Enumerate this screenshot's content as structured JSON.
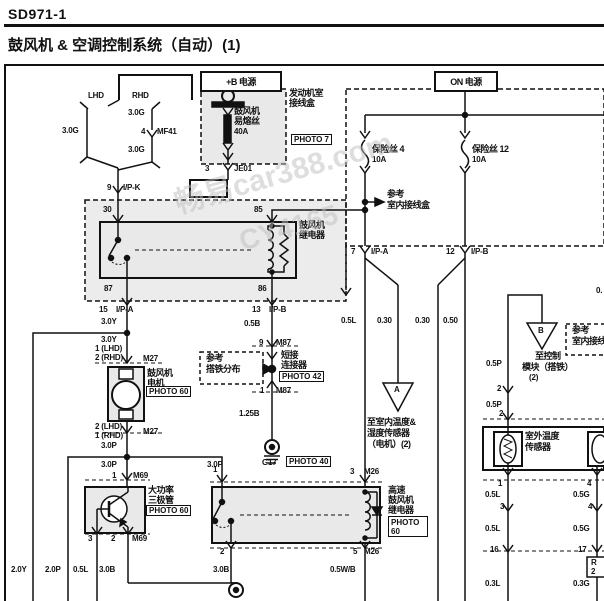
{
  "page": {
    "doc_code": "SD971-1",
    "title": "鼓风机 & 空调控制系统（自动）(1)"
  },
  "watermark": {
    "line1": "畅易car388.com",
    "line2": "CY4165"
  },
  "power_boxes": {
    "b_plus": "+B 电源",
    "on": "ON 电源"
  },
  "photo_refs": {
    "p7": "PHOTO 7",
    "p42": "PHOTO 42",
    "p40": "PHOTO 40",
    "p60_motor": "PHOTO 60",
    "p60_tr": "PHOTO 60",
    "p60_hs_1": "PHOTO",
    "p60_hs_2": "60"
  },
  "components": {
    "engine_room_box": "发动机室接线盒",
    "blower_fusible_link": "鼓风机易熔丝 40A",
    "fuse4": "保险丝 4 10A",
    "fuse12": "保险丝 12 10A",
    "blower_relay": "鼓风机继电器",
    "blower_motor": "鼓风机电机",
    "jumper_connector": "短接连接器",
    "power_transistor": "大功率三极管",
    "high_speed_blower_relay": "高速鼓风机继电器",
    "ambient_temp_sensor": "室外温度传感器",
    "ref_indoor_junction_box": "参考 室内接线盒",
    "ref_ground_distribution": "参考 搭铁分布",
    "to_indoor_temp_humidity_sensor": "至室内温度&湿度传感器（电机）(2)",
    "to_control_module_ground": "至控制模块（搭铁）(2)",
    "ground_g17": "G17"
  },
  "labels": [
    {
      "t": "LHD",
      "x": 88,
      "y": 92,
      "c": "w",
      "n": "label-lhd"
    },
    {
      "t": "RHD",
      "x": 132,
      "y": 92,
      "c": "w",
      "n": "label-rhd"
    },
    {
      "t": "3.0G",
      "x": 62,
      "y": 127,
      "c": "w",
      "n": "wire-3-0g-lhd"
    },
    {
      "t": "3.0G",
      "x": 128,
      "y": 109,
      "c": "w",
      "n": "wire-3-0g-rhd-1"
    },
    {
      "t": "4",
      "x": 141,
      "y": 128,
      "c": "w",
      "n": "pin-4-mf41"
    },
    {
      "t": "MF41",
      "x": 157,
      "y": 128,
      "c": "w",
      "n": "connector-mf41"
    },
    {
      "t": "3.0G",
      "x": 128,
      "y": 146,
      "c": "w",
      "n": "wire-3-0g-rhd-2"
    },
    {
      "t": "9",
      "x": 107,
      "y": 184,
      "c": "w",
      "n": "pin-9-ipk"
    },
    {
      "t": "I/P-K",
      "x": 123,
      "y": 184,
      "c": "w",
      "n": "connector-ipk"
    },
    {
      "t": "30",
      "x": 103,
      "y": 206,
      "c": "w",
      "n": "relay-pin-30"
    },
    {
      "t": "85",
      "x": 254,
      "y": 206,
      "c": "w",
      "n": "relay-pin-85"
    },
    {
      "t": "鼓风机",
      "x": 299,
      "y": 221,
      "c": "c",
      "n": "blower-relay-label-1"
    },
    {
      "t": "继电器",
      "x": 299,
      "y": 231,
      "c": "c",
      "n": "blower-relay-label-2"
    },
    {
      "t": "87",
      "x": 104,
      "y": 285,
      "c": "w",
      "n": "relay-pin-87"
    },
    {
      "t": "86",
      "x": 258,
      "y": 285,
      "c": "w",
      "n": "relay-pin-86"
    },
    {
      "t": "15",
      "x": 99,
      "y": 306,
      "c": "w",
      "n": "pin-15-ipa"
    },
    {
      "t": "I/P-A",
      "x": 116,
      "y": 306,
      "c": "w",
      "n": "connector-ipa-left"
    },
    {
      "t": "13",
      "x": 252,
      "y": 306,
      "c": "w",
      "n": "pin-13-ipb"
    },
    {
      "t": "I/P-B",
      "x": 269,
      "y": 306,
      "c": "w",
      "n": "connector-ipb-left"
    },
    {
      "t": "3.0Y",
      "x": 101,
      "y": 318,
      "c": "w",
      "n": "wire-3-0y-1"
    },
    {
      "t": "3.0Y",
      "x": 101,
      "y": 336,
      "c": "w",
      "n": "wire-3-0y-2"
    },
    {
      "t": "1 (LHD)",
      "x": 95,
      "y": 345,
      "c": "w",
      "n": "motor-pin-top-lhd"
    },
    {
      "t": "2 (RHD)",
      "x": 95,
      "y": 354,
      "c": "w",
      "n": "motor-pin-top-rhd"
    },
    {
      "t": "M27",
      "x": 143,
      "y": 355,
      "c": "w",
      "n": "connector-m27-top"
    },
    {
      "t": "鼓风机",
      "x": 147,
      "y": 369,
      "c": "c",
      "n": "blower-motor-label-1"
    },
    {
      "t": "电机",
      "x": 147,
      "y": 379,
      "c": "c",
      "n": "blower-motor-label-2"
    },
    {
      "t": "参考",
      "x": 206,
      "y": 354,
      "c": "c",
      "n": "ref-ground-dist-1"
    },
    {
      "t": "搭铁分布",
      "x": 206,
      "y": 365,
      "c": "c",
      "n": "ref-ground-dist-2"
    },
    {
      "t": "0.5B",
      "x": 244,
      "y": 320,
      "c": "w",
      "n": "wire-0-5b"
    },
    {
      "t": "9",
      "x": 259,
      "y": 339,
      "c": "w",
      "n": "pin-9-m87"
    },
    {
      "t": "M87",
      "x": 276,
      "y": 339,
      "c": "w",
      "n": "connector-m87-top"
    },
    {
      "t": "短接",
      "x": 281,
      "y": 351,
      "c": "c",
      "n": "jumper-label-1"
    },
    {
      "t": "连接器",
      "x": 281,
      "y": 361,
      "c": "c",
      "n": "jumper-label-2"
    },
    {
      "t": "1",
      "x": 260,
      "y": 387,
      "c": "w",
      "n": "pin-1-m87"
    },
    {
      "t": "M87",
      "x": 276,
      "y": 387,
      "c": "w",
      "n": "connector-m87-bottom"
    },
    {
      "t": "1.25B",
      "x": 239,
      "y": 410,
      "c": "w",
      "n": "wire-1-25b"
    },
    {
      "t": "G17",
      "x": 262,
      "y": 459,
      "c": "w",
      "n": "ground-g17-label"
    },
    {
      "t": "2 (LHD)",
      "x": 95,
      "y": 423,
      "c": "w",
      "n": "motor-pin-bot-lhd"
    },
    {
      "t": "1 (RHD)",
      "x": 95,
      "y": 432,
      "c": "w",
      "n": "motor-pin-bot-rhd"
    },
    {
      "t": "M27",
      "x": 143,
      "y": 428,
      "c": "w",
      "n": "connector-m27-bottom"
    },
    {
      "t": "3.0P",
      "x": 101,
      "y": 442,
      "c": "w",
      "n": "wire-3-0p-1"
    },
    {
      "t": "3.0P",
      "x": 101,
      "y": 461,
      "c": "w",
      "n": "wire-3-0p-2"
    },
    {
      "t": "3.0P",
      "x": 207,
      "y": 461,
      "c": "w",
      "n": "wire-3-0p-3"
    },
    {
      "t": "1",
      "x": 112,
      "y": 472,
      "c": "w",
      "n": "transistor-pin-1"
    },
    {
      "t": "M69",
      "x": 133,
      "y": 472,
      "c": "w",
      "n": "connector-m69-top"
    },
    {
      "t": "大功率",
      "x": 148,
      "y": 486,
      "c": "c",
      "n": "power-transistor-label-1"
    },
    {
      "t": "三极管",
      "x": 148,
      "y": 496,
      "c": "c",
      "n": "power-transistor-label-2"
    },
    {
      "t": "3",
      "x": 88,
      "y": 535,
      "c": "w",
      "n": "transistor-pin-3"
    },
    {
      "t": "2",
      "x": 111,
      "y": 535,
      "c": "w",
      "n": "transistor-pin-2"
    },
    {
      "t": "M69",
      "x": 132,
      "y": 535,
      "c": "w",
      "n": "connector-m69-bottom"
    },
    {
      "t": "2.0Y",
      "x": 11,
      "y": 566,
      "c": "w",
      "n": "wire-2-0y"
    },
    {
      "t": "2.0P",
      "x": 45,
      "y": 566,
      "c": "w",
      "n": "wire-2-0p"
    },
    {
      "t": "0.5L",
      "x": 73,
      "y": 566,
      "c": "w",
      "n": "wire-0-5l-bottom"
    },
    {
      "t": "3.0B",
      "x": 99,
      "y": 566,
      "c": "w",
      "n": "wire-3-0b-left"
    },
    {
      "t": "3.0B",
      "x": 213,
      "y": 566,
      "c": "w",
      "n": "wire-3-0b-relay"
    },
    {
      "t": "0.5W/B",
      "x": 330,
      "y": 566,
      "c": "w",
      "n": "wire-0-5wb"
    },
    {
      "t": "1",
      "x": 213,
      "y": 466,
      "c": "w",
      "n": "hs-relay-pin-1"
    },
    {
      "t": "3",
      "x": 350,
      "y": 468,
      "c": "w",
      "n": "hs-relay-pin-3"
    },
    {
      "t": "M26",
      "x": 364,
      "y": 468,
      "c": "w",
      "n": "connector-m26-top"
    },
    {
      "t": "高速",
      "x": 388,
      "y": 486,
      "c": "c",
      "n": "hs-relay-label-1"
    },
    {
      "t": "鼓风机",
      "x": 388,
      "y": 496,
      "c": "c",
      "n": "hs-relay-label-2"
    },
    {
      "t": "继电器",
      "x": 388,
      "y": 506,
      "c": "c",
      "n": "hs-relay-label-3"
    },
    {
      "t": "2",
      "x": 220,
      "y": 548,
      "c": "w",
      "n": "hs-relay-pin-2"
    },
    {
      "t": "5",
      "x": 353,
      "y": 548,
      "c": "w",
      "n": "hs-relay-pin-5"
    },
    {
      "t": "M26",
      "x": 364,
      "y": 548,
      "c": "w",
      "n": "connector-m26-bottom"
    },
    {
      "t": "发动机室",
      "x": 289,
      "y": 89,
      "c": "c",
      "n": "engine-room-box-label-1"
    },
    {
      "t": "接线盒",
      "x": 289,
      "y": 99,
      "c": "c",
      "n": "engine-room-box-label-2"
    },
    {
      "t": "鼓风机",
      "x": 234,
      "y": 107,
      "c": "c",
      "n": "fusible-link-label-1"
    },
    {
      "t": "易熔丝",
      "x": 234,
      "y": 117,
      "c": "c",
      "n": "fusible-link-label-2"
    },
    {
      "t": "40A",
      "x": 234,
      "y": 128,
      "c": "w",
      "n": "fusible-link-rating"
    },
    {
      "t": "3",
      "x": 205,
      "y": 165,
      "c": "w",
      "n": "pin-3-je01"
    },
    {
      "t": "JE01",
      "x": 234,
      "y": 165,
      "c": "w",
      "n": "connector-je01"
    },
    {
      "t": "保险丝 4",
      "x": 372,
      "y": 145,
      "c": "c",
      "n": "fuse4-label"
    },
    {
      "t": "10A",
      "x": 372,
      "y": 156,
      "c": "w",
      "n": "fuse4-rating"
    },
    {
      "t": "保险丝 12",
      "x": 472,
      "y": 145,
      "c": "c",
      "n": "fuse12-label"
    },
    {
      "t": "10A",
      "x": 472,
      "y": 156,
      "c": "w",
      "n": "fuse12-rating"
    },
    {
      "t": "参考",
      "x": 387,
      "y": 190,
      "c": "c",
      "n": "ref-indoor-box-1"
    },
    {
      "t": "室内接线盒",
      "x": 387,
      "y": 201,
      "c": "c",
      "n": "ref-indoor-box-2"
    },
    {
      "t": "7",
      "x": 351,
      "y": 248,
      "c": "w",
      "n": "pin-7-ipa"
    },
    {
      "t": "I/P-A",
      "x": 371,
      "y": 248,
      "c": "w",
      "n": "connector-ipa-right"
    },
    {
      "t": "12",
      "x": 446,
      "y": 248,
      "c": "w",
      "n": "pin-12-ipb"
    },
    {
      "t": "I/P-B",
      "x": 471,
      "y": 248,
      "c": "w",
      "n": "connector-ipb-right"
    },
    {
      "t": "0.5L",
      "x": 341,
      "y": 317,
      "c": "w",
      "n": "wire-0-5l-mid"
    },
    {
      "t": "0.30",
      "x": 377,
      "y": 317,
      "c": "w",
      "n": "wire-0-30-a"
    },
    {
      "t": "0.30",
      "x": 415,
      "y": 317,
      "c": "w",
      "n": "wire-0-30-b"
    },
    {
      "t": "0.50",
      "x": 443,
      "y": 317,
      "c": "w",
      "n": "wire-0-50"
    },
    {
      "t": "A",
      "x": 394,
      "y": 386,
      "c": "w",
      "n": "offpage-a"
    },
    {
      "t": "至室内温度&",
      "x": 367,
      "y": 418,
      "c": "c",
      "n": "to-indoor-sensor-1"
    },
    {
      "t": "湿度传感器",
      "x": 367,
      "y": 429,
      "c": "c",
      "n": "to-indoor-sensor-2"
    },
    {
      "t": "（电机）(2)",
      "x": 367,
      "y": 440,
      "c": "c",
      "n": "to-indoor-sensor-3"
    },
    {
      "t": "B",
      "x": 538,
      "y": 327,
      "c": "w",
      "n": "offpage-b"
    },
    {
      "t": "至控制",
      "x": 535,
      "y": 352,
      "c": "c",
      "n": "to-control-module-1"
    },
    {
      "t": "模块（搭铁）",
      "x": 522,
      "y": 363,
      "c": "c",
      "n": "to-control-module-2"
    },
    {
      "t": "(2)",
      "x": 529,
      "y": 374,
      "c": "w",
      "n": "to-control-module-3"
    },
    {
      "t": "0.5P",
      "x": 486,
      "y": 360,
      "c": "w",
      "n": "wire-0-5p-1"
    },
    {
      "t": "2",
      "x": 497,
      "y": 385,
      "c": "w",
      "n": "sensor-conn-2a"
    },
    {
      "t": "0.5P",
      "x": 486,
      "y": 401,
      "c": "w",
      "n": "wire-0-5p-2"
    },
    {
      "t": "2",
      "x": 499,
      "y": 410,
      "c": "w",
      "n": "sensor-pin-2"
    },
    {
      "t": "参考",
      "x": 572,
      "y": 326,
      "c": "c",
      "n": "ref-indoor-box-right-1"
    },
    {
      "t": "室内接线盒",
      "x": 572,
      "y": 337,
      "c": "c",
      "n": "ref-indoor-box-right-2"
    },
    {
      "t": "0.",
      "x": 596,
      "y": 287,
      "c": "w",
      "n": "wire-partial-right"
    },
    {
      "t": "室外温度",
      "x": 525,
      "y": 432,
      "c": "c",
      "n": "ambient-sensor-label-1"
    },
    {
      "t": "传感器",
      "x": 525,
      "y": 443,
      "c": "c",
      "n": "ambient-sensor-label-2"
    },
    {
      "t": "1",
      "x": 498,
      "y": 480,
      "c": "w",
      "n": "sensor-pin-1"
    },
    {
      "t": "4",
      "x": 587,
      "y": 480,
      "c": "w",
      "n": "sensor2-pin-4"
    },
    {
      "t": "0.5L",
      "x": 485,
      "y": 491,
      "c": "w",
      "n": "wire-0-5l-s1"
    },
    {
      "t": "0.5G",
      "x": 573,
      "y": 491,
      "c": "w",
      "n": "wire-0-5g-s1"
    },
    {
      "t": "3",
      "x": 500,
      "y": 503,
      "c": "w",
      "n": "conn-3"
    },
    {
      "t": "4",
      "x": 588,
      "y": 503,
      "c": "w",
      "n": "conn-4"
    },
    {
      "t": "0.5L",
      "x": 485,
      "y": 525,
      "c": "w",
      "n": "wire-0-5l-s2"
    },
    {
      "t": "0.5G",
      "x": 573,
      "y": 525,
      "c": "w",
      "n": "wire-0-5g-s2"
    },
    {
      "t": "16",
      "x": 490,
      "y": 546,
      "c": "w",
      "n": "conn-16"
    },
    {
      "t": "17",
      "x": 578,
      "y": 546,
      "c": "w",
      "n": "conn-17"
    },
    {
      "t": "0.3L",
      "x": 485,
      "y": 580,
      "c": "w",
      "n": "wire-0-3l"
    },
    {
      "t": "0.3G",
      "x": 573,
      "y": 580,
      "c": "w",
      "n": "wire-0-3g"
    },
    {
      "t": "R",
      "x": 591,
      "y": 559,
      "c": "w",
      "n": "clipped-box-char-1"
    },
    {
      "t": "2",
      "x": 591,
      "y": 568,
      "c": "w",
      "n": "clipped-box-char-2"
    }
  ],
  "photo_boxes": [
    {
      "t": "PHOTO 7",
      "x": 291,
      "y": 134,
      "n": "photo-7-ref"
    },
    {
      "t": "PHOTO 42",
      "x": 279,
      "y": 371,
      "n": "photo-42-ref"
    },
    {
      "t": "PHOTO 40",
      "x": 286,
      "y": 456,
      "n": "photo-40-ref"
    },
    {
      "t": "PHOTO 60",
      "x": 146,
      "y": 386,
      "n": "photo-60-motor-ref"
    },
    {
      "t": "PHOTO 60",
      "x": 146,
      "y": 505,
      "n": "photo-60-transistor-ref"
    }
  ]
}
